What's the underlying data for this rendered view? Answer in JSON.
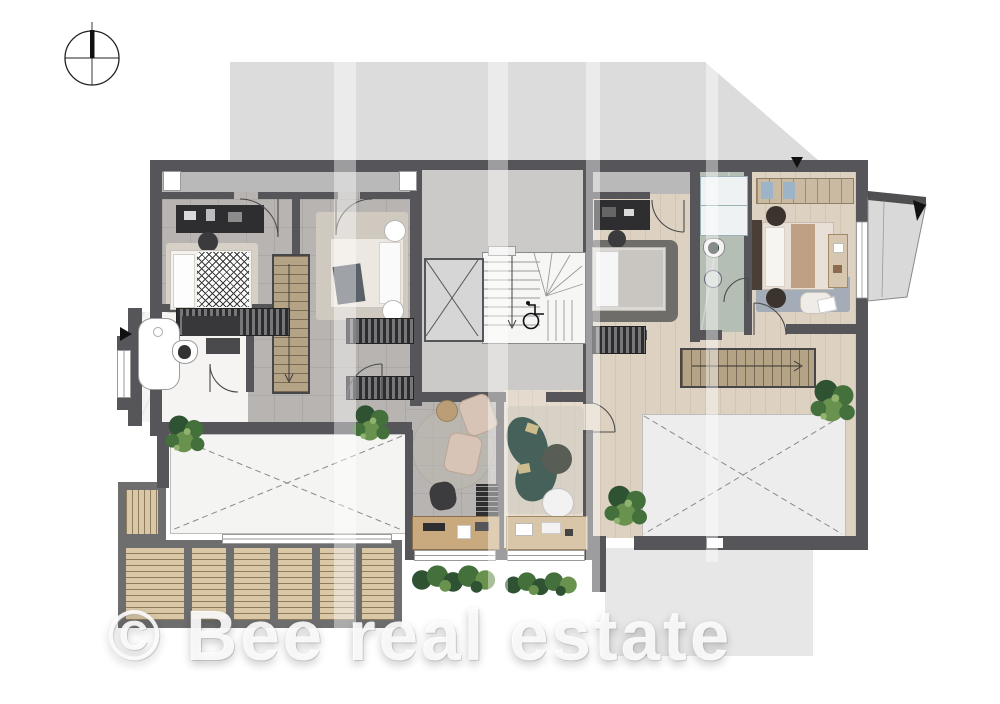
{
  "watermark": {
    "text": "© Bee real estate"
  },
  "icons": {
    "compass": "north-compass-icon",
    "wheelchair": "wheelchair-accessible-icon",
    "entry_arrow": "entry-arrow-icon",
    "north_marker": "north-marker-icon",
    "elevator": "elevator-cross-icon",
    "void": "void-cross-icon",
    "stair_direction": "stair-direction-arrow-icon"
  },
  "colors": {
    "wall": "#56565a",
    "floorTile": "#b7b4b1",
    "floorWood": "#ddd2c2",
    "floorCore": "#cbcac8",
    "floorStudy": "#e4dbce",
    "stairWood": "#b4a385",
    "deckWood": "#d9c7a6",
    "deckFrame": "#6e6e6e",
    "marbleWhite": "#f5f4f2",
    "marbleGreen": "#b5beb5",
    "silhouette": "#dcdcdc",
    "voidFill": "#ededed",
    "sofaTeal": "#46615a",
    "chairBlush": "#d8c4b6",
    "rugBlue": "#a4acb8",
    "rugDark": "#6e6d69",
    "plantDark": "#2e5232",
    "plantMid": "#44703c",
    "plantLight": "#69924f",
    "furnitureDark": "#2e2e30",
    "groundShadow": "#e7e7e7",
    "watermarkColor": "rgba(255,255,255,0.88)"
  }
}
